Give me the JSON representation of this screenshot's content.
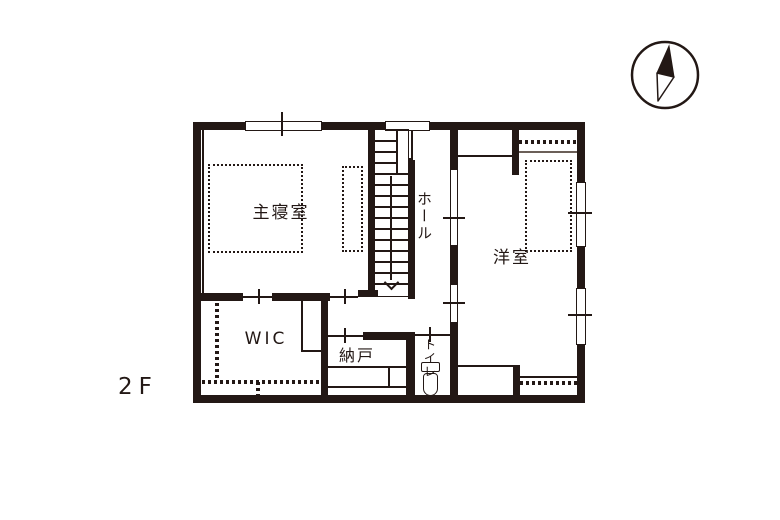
{
  "title": "2F floor plan",
  "colors": {
    "ink": "#231815",
    "background": "#ffffff"
  },
  "floor_label": "2F",
  "labels": {
    "master_bedroom": "主寝室",
    "hall": "ホール",
    "western_room": "洋室",
    "walk_in_closet": "WIC",
    "storage": "納戸",
    "toilet": "トイレ"
  },
  "icons": {
    "compass": "north-compass-icon",
    "toilet_fixture": "toilet-icon",
    "stairs_direction": "stairs-down-arrow-icon"
  }
}
